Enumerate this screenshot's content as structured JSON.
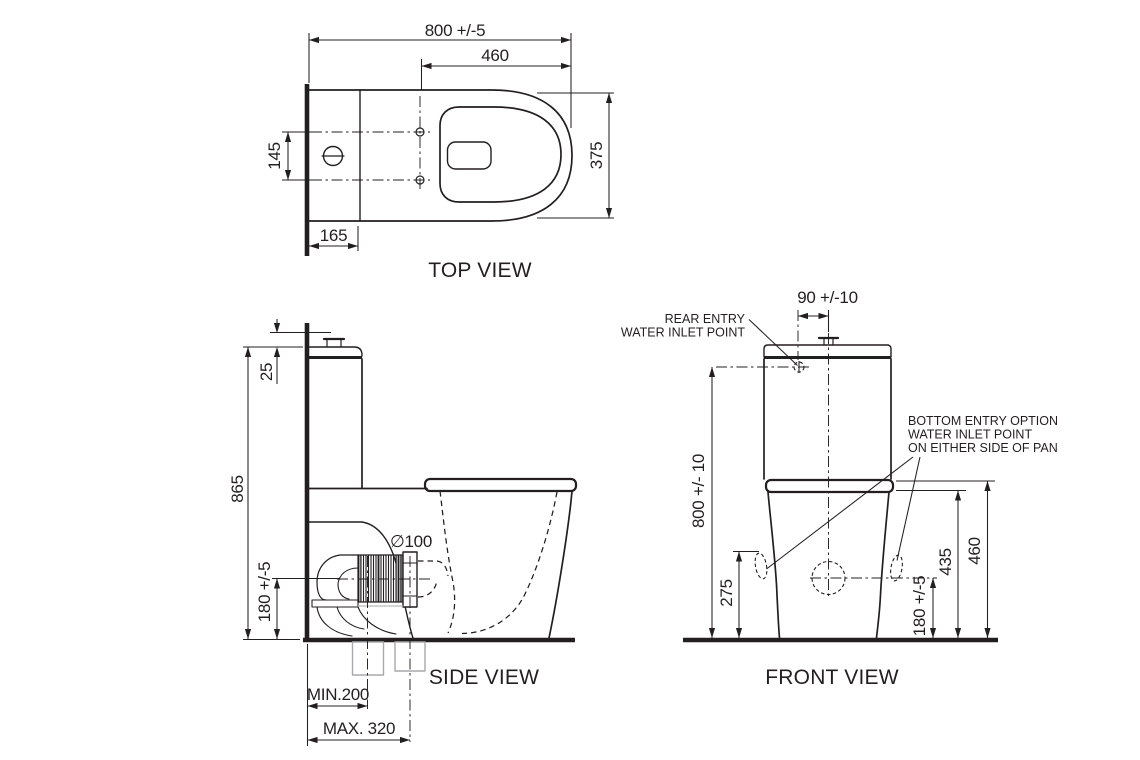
{
  "drawing": {
    "colors": {
      "line": "#231f20",
      "gray": "#a7a9ac",
      "background": "#ffffff"
    },
    "views": {
      "top": {
        "title": "TOP VIEW",
        "dims": {
          "overall_depth": "800 +/-5",
          "seat_length": "460",
          "pan_width": "375",
          "fixing_centres": "145",
          "cistern_depth": "165"
        }
      },
      "side": {
        "title": "SIDE VIEW",
        "dims": {
          "lid_height": "25",
          "overall_height": "865",
          "outlet_centre_height": "180 +/-5",
          "outlet_diameter": "∅100",
          "setout_min": "MIN.200",
          "setout_max": "MAX. 320"
        }
      },
      "front": {
        "title": "FRONT VIEW",
        "dims": {
          "inlet_offset_from_centre": "90 +/-10",
          "inlet_height": "800 +/- 10",
          "side_inlet_height": "275",
          "pan_rim_height": "435",
          "seat_height": "460",
          "outlet_centre_height": "180 +/-5"
        },
        "notes": {
          "rear_entry": [
            "REAR ENTRY",
            "WATER INLET POINT"
          ],
          "bottom_entry": [
            "BOTTOM ENTRY OPTION",
            "WATER INLET POINT",
            "ON EITHER SIDE OF PAN"
          ]
        }
      }
    }
  }
}
